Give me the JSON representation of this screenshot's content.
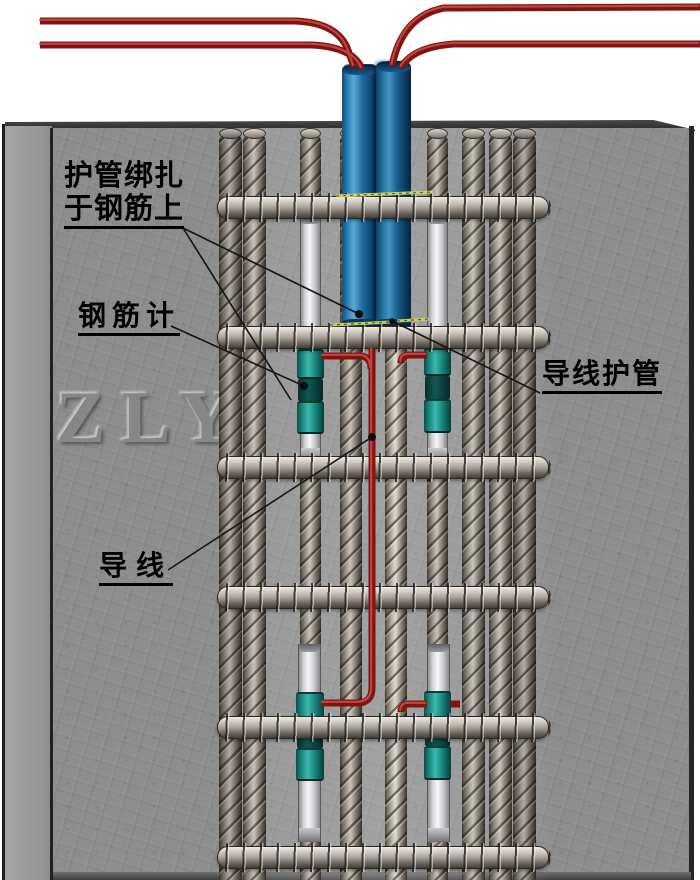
{
  "diagram": {
    "watermark": "ZLY",
    "labels": {
      "tube_tied_line1": "护管绑扎",
      "tube_tied_line2": "于钢筋上",
      "rebar_gauge": "钢筋计",
      "wire_conduit": "导线护管",
      "wire": "导线"
    },
    "components": {
      "conduit_tubes": 2,
      "rebar_gauges": 4,
      "spiral_hoops": 6,
      "vertical_bars": 9,
      "surface_lead_wires": 4
    },
    "colors": {
      "conduit_blue": "#1d6a9e",
      "gauge_teal": "#1f9288",
      "wire_red": "#801414",
      "binding_yellow": "#cfcf72",
      "concrete_gray": "#8d8d8d",
      "label_black": "#000000"
    }
  }
}
